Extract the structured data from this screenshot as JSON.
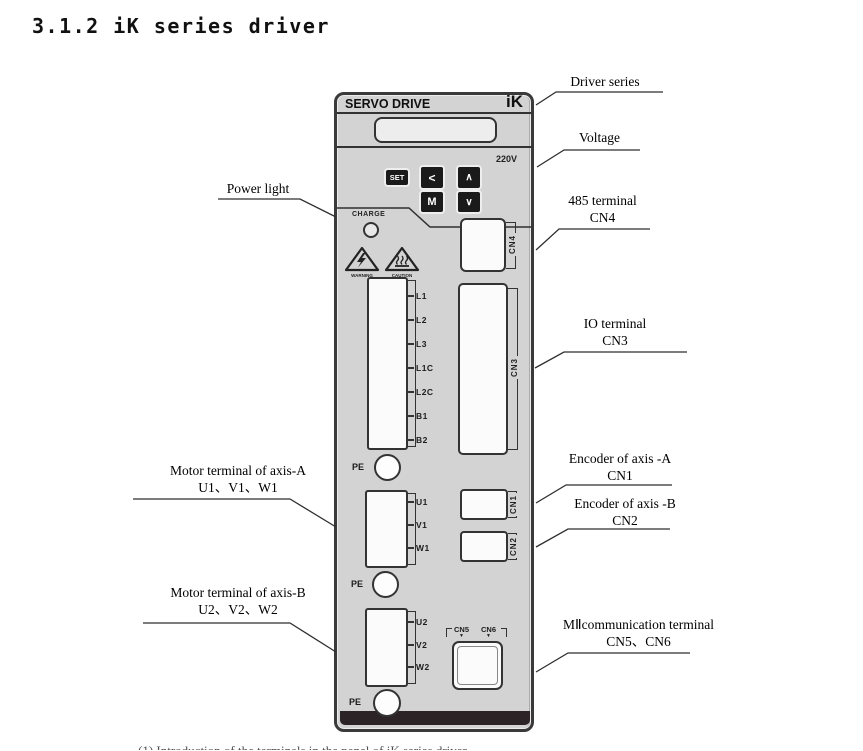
{
  "page": {
    "title": "3.1.2 iK series driver"
  },
  "device": {
    "brand": "SERVO DRIVE",
    "logo": "iK",
    "voltage": "220V",
    "buttons": {
      "set": "SET",
      "left": "<",
      "up": "∧",
      "mode": "M",
      "down": "∨"
    },
    "charge_label": "CHARGE",
    "warning_label": "WARNING",
    "caution_label": "CAUTION",
    "pe_label": "PE",
    "pins_main": [
      "L1",
      "L2",
      "L3",
      "L1C",
      "L2C",
      "B1",
      "B2"
    ],
    "pins_axis_a": [
      "U1",
      "V1",
      "W1"
    ],
    "pins_axis_b": [
      "U2",
      "V2",
      "W2"
    ],
    "connectors": {
      "cn1": "CN1",
      "cn2": "CN2",
      "cn3": "CN3",
      "cn4": "CN4",
      "cn5": "CN5",
      "cn6": "CN6"
    }
  },
  "callouts": {
    "driver_series": {
      "line1": "Driver series"
    },
    "voltage": {
      "line1": "Voltage"
    },
    "terminal_485": {
      "line1": "485 terminal",
      "line2": "CN4"
    },
    "io_terminal": {
      "line1": "IO terminal",
      "line2": "CN3"
    },
    "encoder_a": {
      "line1": "Encoder of axis -A",
      "line2": "CN1"
    },
    "encoder_b": {
      "line1": "Encoder of axis -B",
      "line2": "CN2"
    },
    "mii": {
      "line1": "MⅡcommunication terminal",
      "line2": "CN5、CN6"
    },
    "power_light": {
      "line1": "Power light"
    },
    "motor_a": {
      "line1": "Motor terminal of axis-A",
      "line2": "U1、V1、W1"
    },
    "motor_b": {
      "line1": "Motor terminal of axis-B",
      "line2": "U2、V2、W2"
    }
  },
  "footer": {
    "clipped_text": "(1) Introduction of the terminals in the panel of iK series driver"
  },
  "colors": {
    "device_fill": "#d3d3d3",
    "outline": "#2f2f2f",
    "connector_face": "#fbfbfb",
    "bottom_bar": "#2b2326",
    "button_bg": "#1a1a1a"
  }
}
